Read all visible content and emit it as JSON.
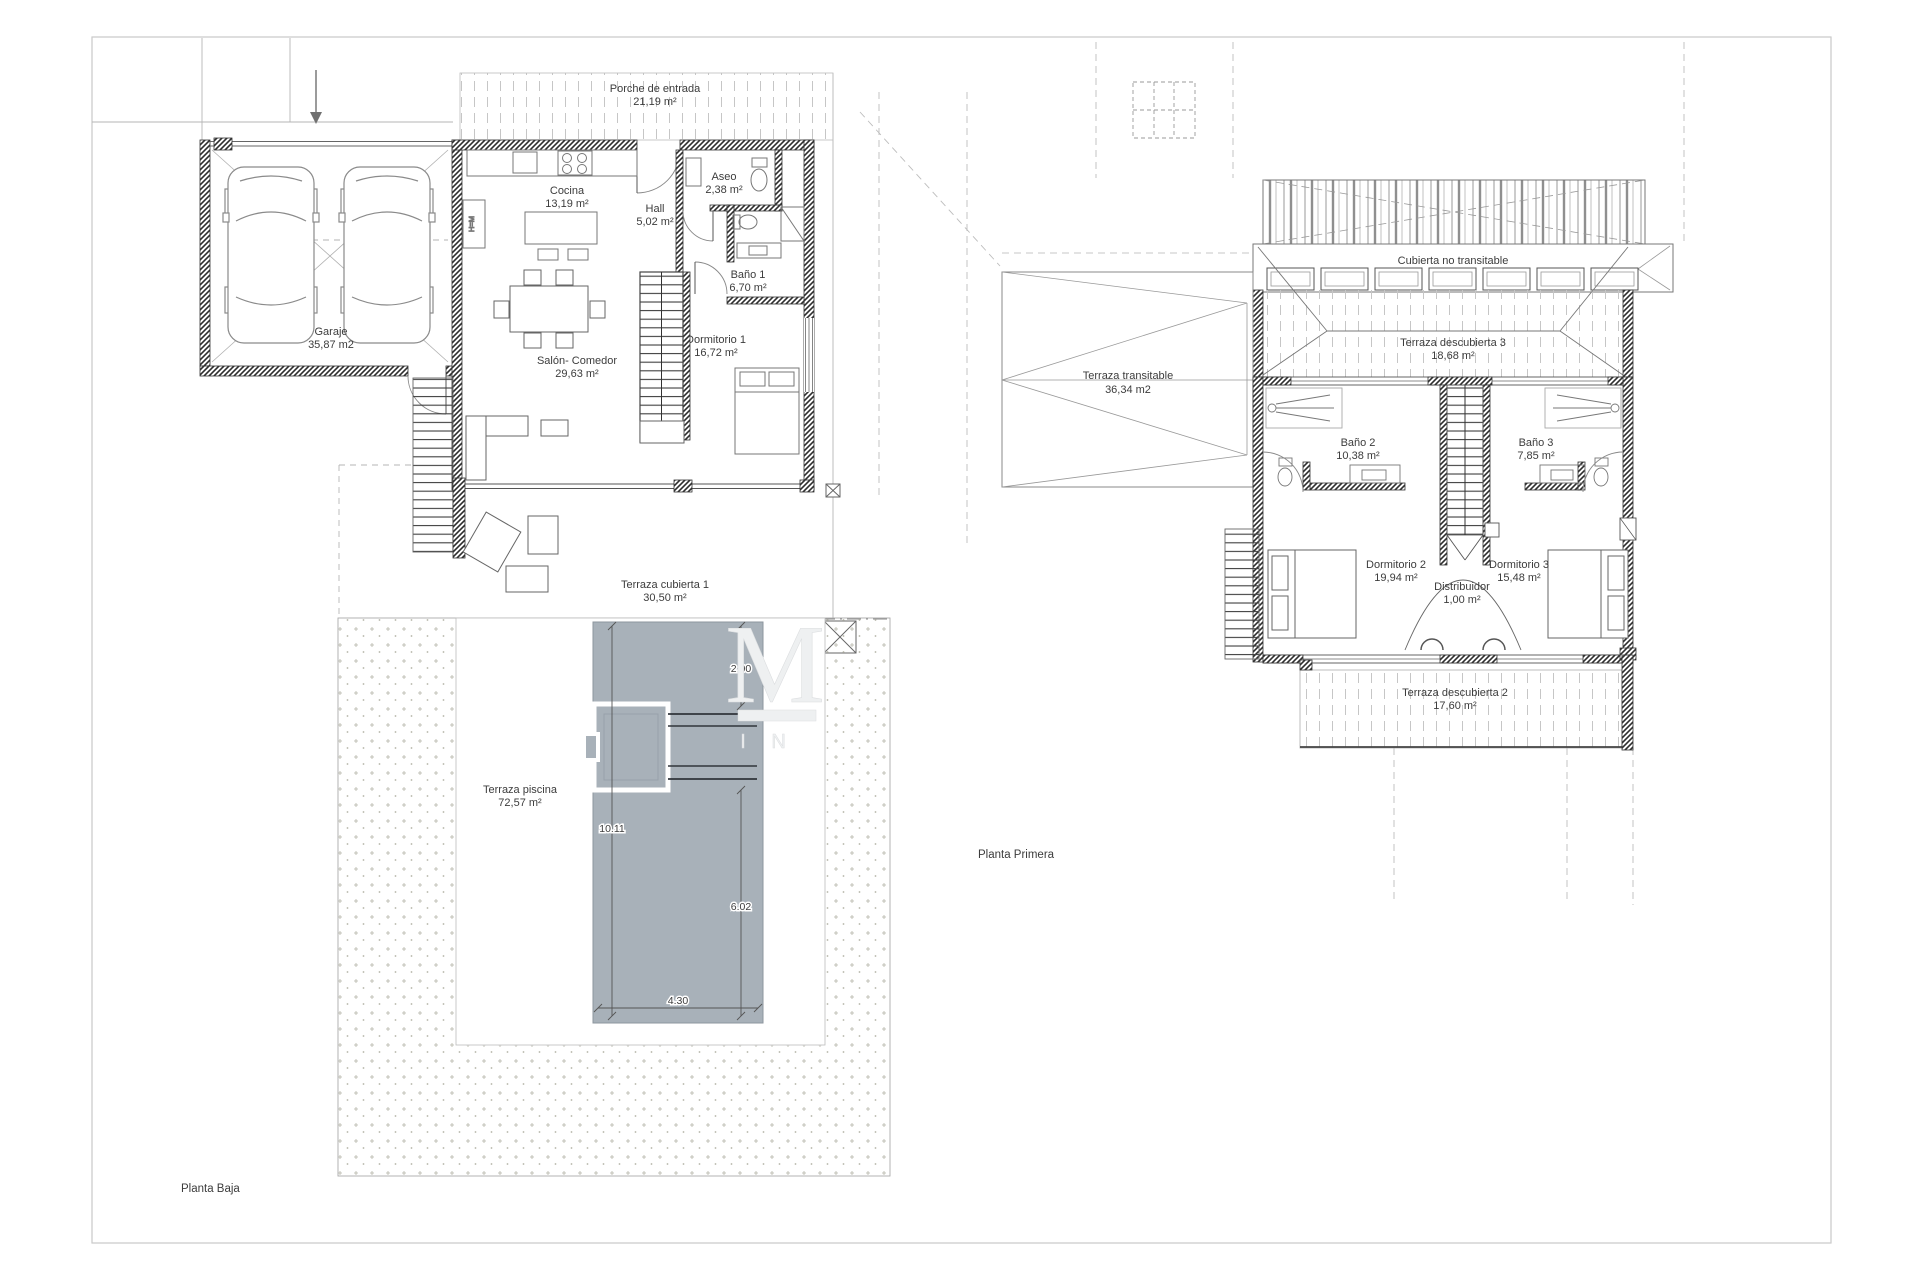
{
  "sheet": {
    "watermark": {
      "monogram": "M",
      "subtext": "I N"
    }
  },
  "planta_baja": {
    "title": "Planta Baja",
    "rooms": {
      "porche": {
        "name": "Porche de entrada",
        "area": "21,19 m²"
      },
      "garaje": {
        "name": "Garaje",
        "area": "35,87 m2"
      },
      "cocina": {
        "name": "Cocina",
        "area": "13,19 m²"
      },
      "hall": {
        "name": "Hall",
        "area": "5,02 m²"
      },
      "aseo": {
        "name": "Aseo",
        "area": "2,38 m²"
      },
      "bano1": {
        "name": "Baño 1",
        "area": "6,70 m²"
      },
      "dormitorio1": {
        "name": "Dormitorio 1",
        "area": "16,72 m²"
      },
      "salon": {
        "name": "Salón- Comedor",
        "area": "29,63 m²"
      },
      "terraza_cubierta1": {
        "name": "Terraza cubierta 1",
        "area": "30,50 m²"
      },
      "terraza_piscina": {
        "name": "Terraza piscina",
        "area": "72,57 m²"
      }
    },
    "labels": {
      "closet": "H=M"
    },
    "pool_dims": {
      "steps_depth": "2.00",
      "length": "10.11",
      "main_length": "6.02",
      "width": "4.30"
    }
  },
  "planta_primera": {
    "title": "Planta Primera",
    "rooms": {
      "cubierta": {
        "name": "Cubierta no transitable",
        "area": ""
      },
      "terraza3": {
        "name": "Terraza descubierta 3",
        "area": "18,68 m²"
      },
      "transitable": {
        "name": "Terraza transitable",
        "area": "36,34 m2"
      },
      "bano2": {
        "name": "Baño 2",
        "area": "10,38 m²"
      },
      "bano3": {
        "name": "Baño 3",
        "area": "7,85 m²"
      },
      "dormitorio2": {
        "name": "Dormitorio 2",
        "area": "19,94 m²"
      },
      "dormitorio3": {
        "name": "Dormitorio 3",
        "area": "15,48 m²"
      },
      "distribuidor": {
        "name": "Distribuidor",
        "area": "1,00 m²"
      },
      "terraza2": {
        "name": "Terraza descubierta 2",
        "area": "17,60 m²"
      }
    }
  }
}
